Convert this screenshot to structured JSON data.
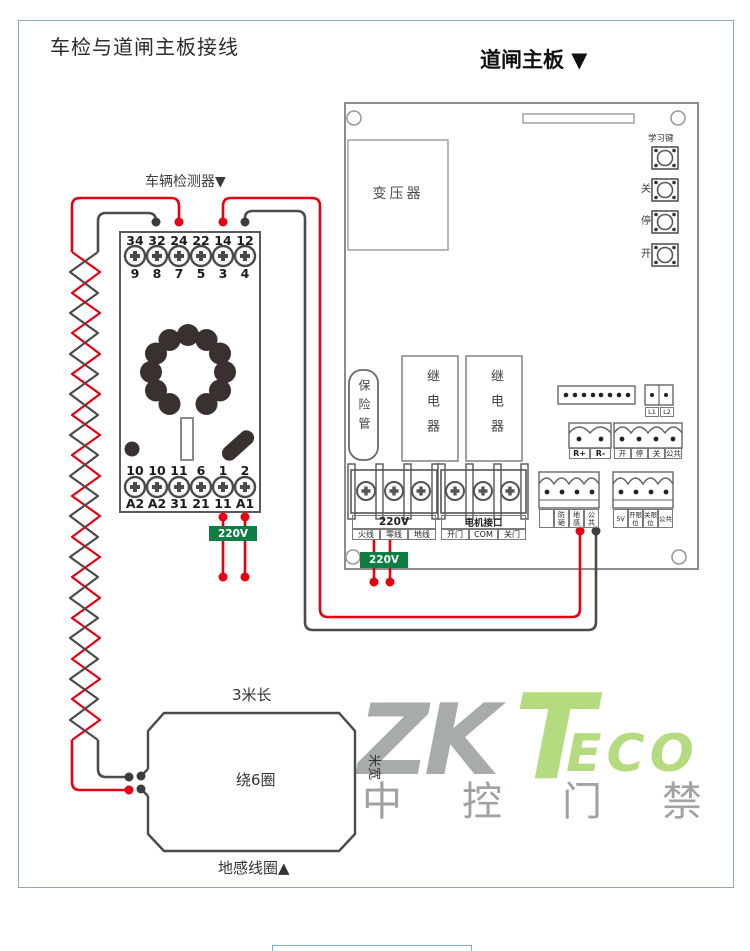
{
  "panel": {
    "title": "车检与道闸主板接线"
  },
  "detector": {
    "label": "车辆检测器▼",
    "top_numbers": [
      "34",
      "32",
      "24",
      "22",
      "14",
      "12"
    ],
    "top_pins": [
      "9",
      "8",
      "7",
      "5",
      "3",
      "4"
    ],
    "bottom_numbers": [
      "10",
      "10",
      "11",
      "6",
      "1",
      "2"
    ],
    "bottom_pins": [
      "A2",
      "A2",
      "31",
      "21",
      "11",
      "A1"
    ],
    "power_tag": "220V"
  },
  "board": {
    "header": "道闸主板 ▼",
    "transformer": "变压器",
    "fuse": "保险管",
    "relay_left": "继电器",
    "relay_right": "继电器",
    "buttons": {
      "learn": "学习键",
      "close": "关",
      "stop": "停",
      "open": "开"
    },
    "l1": "L1",
    "l2": "L2",
    "r_plus": "R+",
    "r_minus": "R-",
    "cmd_open": "开",
    "cmd_stop": "停",
    "cmd_close": "关",
    "cmd_common": "公共",
    "sensor_cells": [
      "",
      "防砸",
      "地感",
      "公共"
    ],
    "limit_cells": [
      "5V",
      "开限位",
      "关限位",
      "公共"
    ],
    "power_title": "220V",
    "power_cells": [
      "火线",
      "零线",
      "地线"
    ],
    "motor_title": "电机接口",
    "motor_cells": [
      "开门",
      "COM",
      "关门"
    ],
    "power_tag": "220V"
  },
  "coil": {
    "length": "3米长",
    "width": "米宽",
    "turns": "绕6圈",
    "name": "地感线圈▲"
  },
  "watermark": {
    "zk": "ZK",
    "t": "T",
    "eco": "ECO",
    "cn": "中控门禁"
  },
  "colors": {
    "wire_red": "#e60012",
    "wire_dark": "#4b4b4b",
    "tag_green": "#0e7e45",
    "panel_border": "#7faacd"
  }
}
